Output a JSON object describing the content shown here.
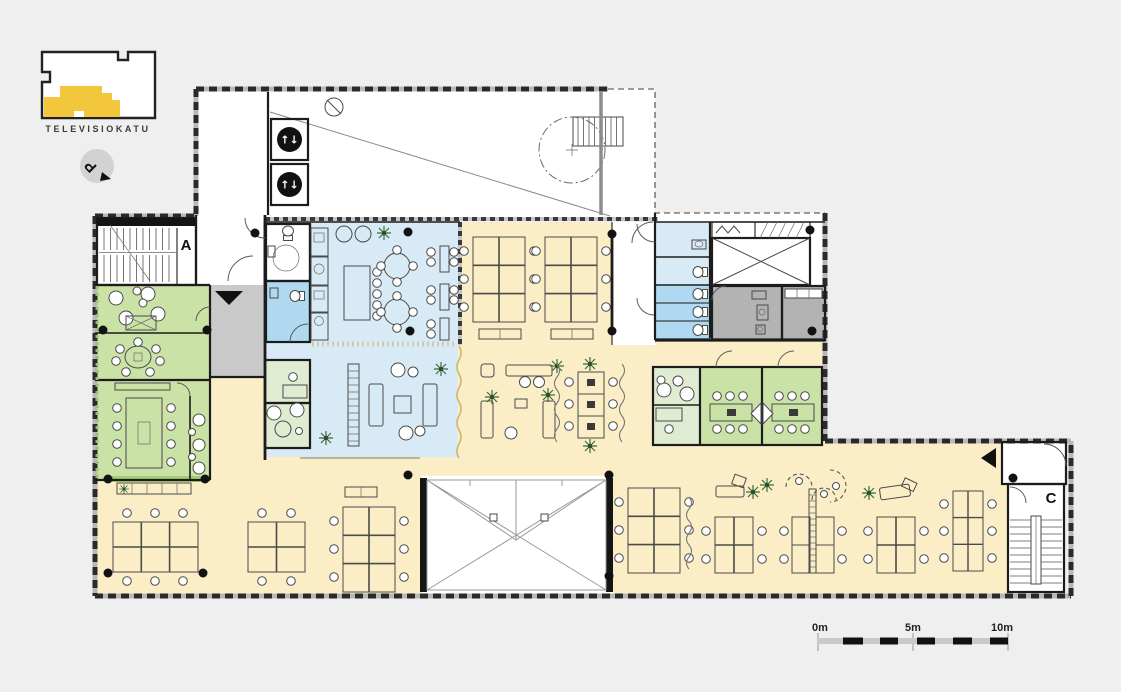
{
  "key_plan": {
    "street_label": "TELEVISIOKATU"
  },
  "north_indicator": {
    "letter": "P"
  },
  "plan_labels": {
    "stair_a": "A",
    "stair_c": "C"
  },
  "elevators": {
    "glyph": "↑↓"
  },
  "scale_bar": {
    "labels": [
      "0m",
      "5m",
      "10m"
    ]
  },
  "colors": {
    "background": "#efeff0",
    "plan_yellow": "#fbeec6",
    "plan_blue": "#d8eaf5",
    "plan_blue_dark": "#aed9f0",
    "plan_green": "#cbe2a7",
    "plan_green_light": "#dfecd2",
    "plan_gray": "#c9c9c9",
    "plan_gray_dark": "#b3b3b3",
    "key_plan_yellow": "#f3c73b",
    "accent_wall_green": "#a5cf6f",
    "wall": "#1c1c1c"
  }
}
